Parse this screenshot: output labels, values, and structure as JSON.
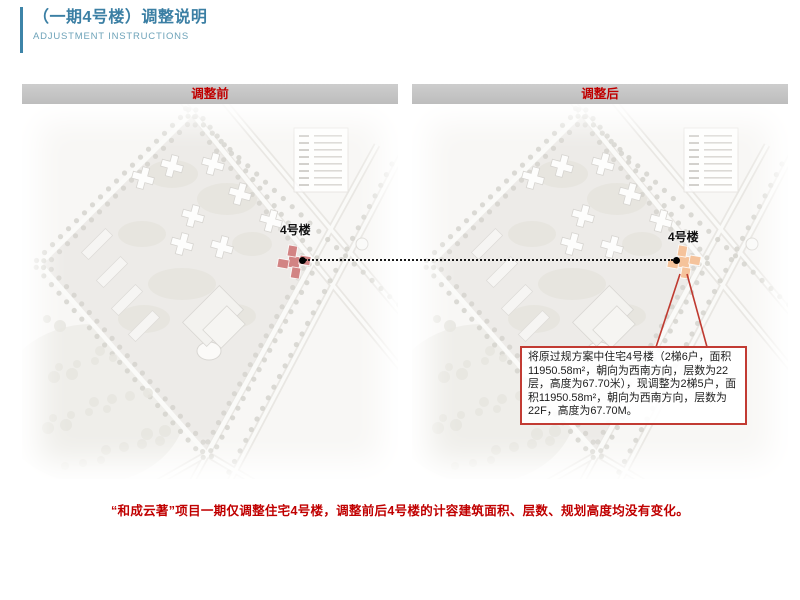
{
  "slide": {
    "title_zh": "（一期4号楼）调整说明",
    "title_en": "ADJUSTMENT INSTRUCTIONS",
    "accent_color": "#3d84a8"
  },
  "panels": {
    "before": {
      "header": "调整前",
      "building_label": "4号楼",
      "highlight_color": "#d28484"
    },
    "after": {
      "header": "调整后",
      "building_label": "4号楼",
      "highlight_color": "#f5c39b"
    }
  },
  "callout": {
    "text": "将原过规方案中住宅4号楼（2梯6户，面积11950.58m²，朝向为西南方向，层数为22层，高度为67.70米），现调整为2梯5户，面积11950.58m²，朝向为西南方向，层数为22F，高度为67.70M。",
    "border_color": "#c23b33"
  },
  "footer": {
    "text": "“和成云著”项目一期仅调整住宅4号楼，调整前后4号楼的计容建筑面积、层数、规划高度均没有变化。",
    "color": "#c00000"
  },
  "colors": {
    "header_text": "#c00000",
    "dotted_line": "#1a1a1a",
    "marker_dot": "#000000",
    "callout_line": "#bf3a30"
  }
}
